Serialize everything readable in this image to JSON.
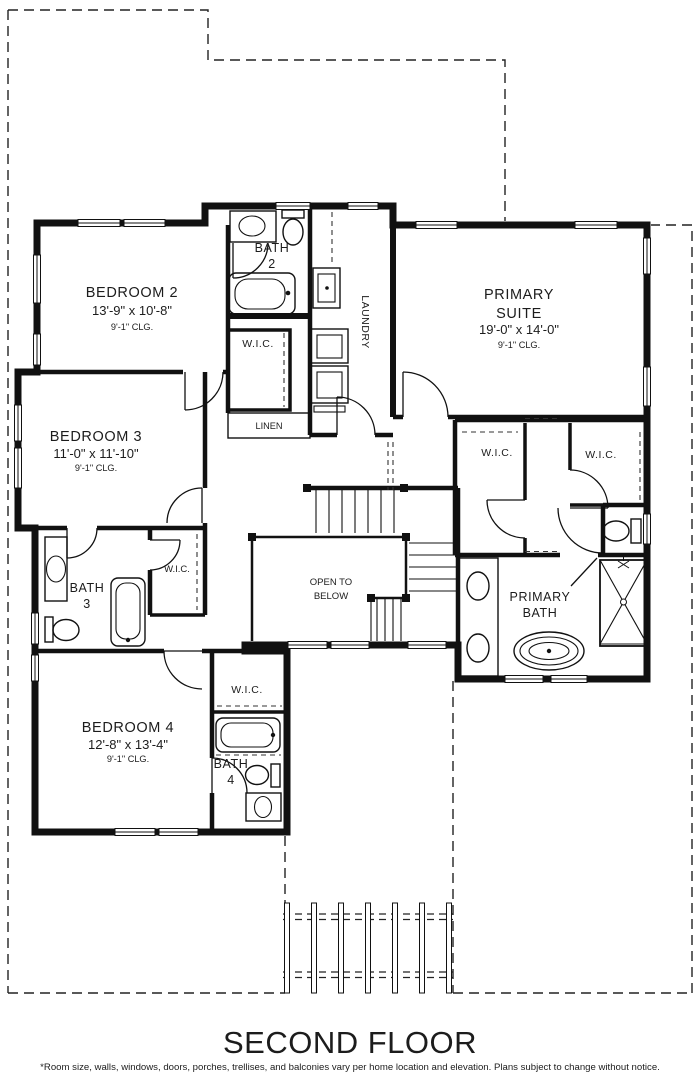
{
  "title": "SECOND FLOOR",
  "disclaimer": "*Room size, walls, windows, doors, porches, trellises, and balconies vary per home location and elevation. Plans subject to change without notice.",
  "rooms": {
    "bedroom2": {
      "name": "BEDROOM 2",
      "dims": "13'-9\" x 10'-8\"",
      "clg": "9'-1\" CLG."
    },
    "bedroom3": {
      "name": "BEDROOM 3",
      "dims": "11'-0\" x 11'-10\"",
      "clg": "9'-1\" CLG."
    },
    "bedroom4": {
      "name": "BEDROOM 4",
      "dims": "12'-8\" x 13'-4\"",
      "clg": "9'-1\" CLG."
    },
    "primary_suite": {
      "line1": "PRIMARY",
      "line2": "SUITE",
      "dims": "19'-0\" x 14'-0\"",
      "clg": "9'-1\" CLG."
    },
    "primary_bath": {
      "line1": "PRIMARY",
      "line2": "BATH"
    },
    "bath2": {
      "line1": "BATH",
      "line2": "2"
    },
    "bath3": {
      "line1": "BATH",
      "line2": "3"
    },
    "bath4": {
      "line1": "BATH",
      "line2": "4"
    },
    "laundry": "LAUNDRY",
    "linen": "LINEN",
    "wic": "W.I.C.",
    "open_to_below": {
      "line1": "OPEN TO",
      "line2": "BELOW"
    }
  }
}
